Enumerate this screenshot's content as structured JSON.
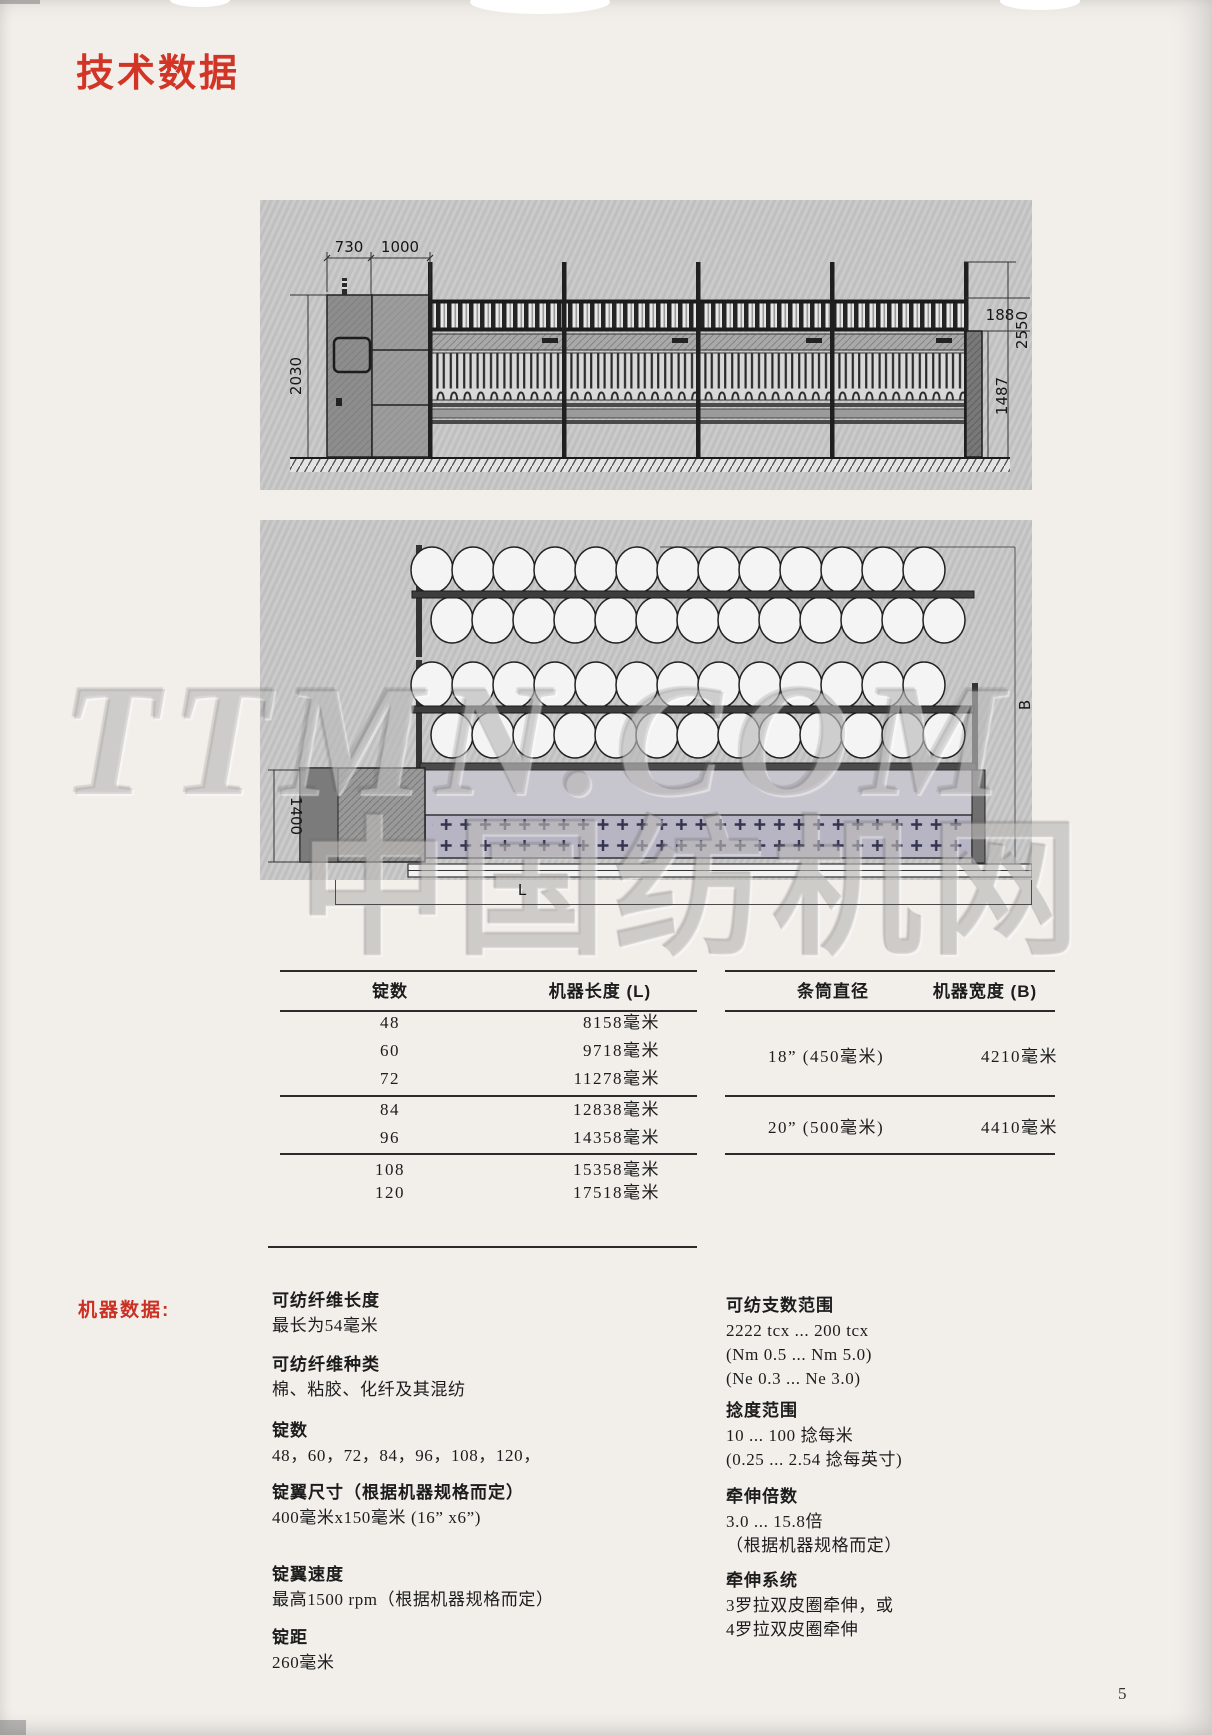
{
  "page": {
    "title": "技术数据",
    "number": "5"
  },
  "side_view": {
    "d730": "730",
    "d1000": "1000",
    "d2030": "2030",
    "d188": "188",
    "d1487": "1487",
    "d2550": "2550"
  },
  "plan_view": {
    "d1400": "1400",
    "dB": "B",
    "dL": "L",
    "watermark_top": "TTMN.COM",
    "watermark_bottom": "中国纺机网"
  },
  "table_left": {
    "headers": [
      "锭数",
      "机器长度 (L)"
    ],
    "rows": [
      [
        "48",
        "8158毫米"
      ],
      [
        "60",
        "9718毫米"
      ],
      [
        "72",
        "11278毫米"
      ],
      [
        "84",
        "12838毫米"
      ],
      [
        "96",
        "14358毫米"
      ],
      [
        "108",
        "15358毫米"
      ],
      [
        "120",
        "17518毫米"
      ]
    ]
  },
  "table_right": {
    "headers": [
      "条筒直径",
      "机器宽度 (B)"
    ],
    "rows": [
      [
        "18” (450毫米)",
        "4210毫米"
      ],
      [
        "20” (500毫米)",
        "4410毫米"
      ]
    ]
  },
  "machine_data": {
    "label": "机器数据:",
    "left": [
      {
        "title": "可纺纤维长度",
        "lines": [
          "最长为54毫米"
        ]
      },
      {
        "title": "可纺纤维种类",
        "lines": [
          "棉、粘胶、化纤及其混纺"
        ]
      },
      {
        "title": "锭数",
        "lines": [
          "48，60，72，84，96，108，120，"
        ]
      },
      {
        "title": "锭翼尺寸（根据机器规格而定）",
        "lines": [
          "400毫米x150毫米 (16” x6”)"
        ]
      },
      {
        "title": "锭翼速度",
        "lines": [
          "最高1500 rpm（根据机器规格而定）"
        ]
      },
      {
        "title": "锭距",
        "lines": [
          "260毫米"
        ]
      }
    ],
    "right": [
      {
        "title": "可纺支数范围",
        "lines": [
          "2222 tcx ... 200 tcx",
          "(Nm 0.5 ... Nm 5.0)",
          "(Ne 0.3 ... Ne 3.0)"
        ]
      },
      {
        "title": "捻度范围",
        "lines": [
          "10 ... 100 捻每米",
          "(0.25 ... 2.54 捻每英寸)"
        ]
      },
      {
        "title": "牵伸倍数",
        "lines": [
          "3.0 ... 15.8倍",
          "（根据机器规格而定）"
        ]
      },
      {
        "title": "牵伸系统",
        "lines": [
          "3罗拉双皮圈牵伸，或",
          "4罗拉双皮圈牵伸"
        ]
      }
    ]
  }
}
